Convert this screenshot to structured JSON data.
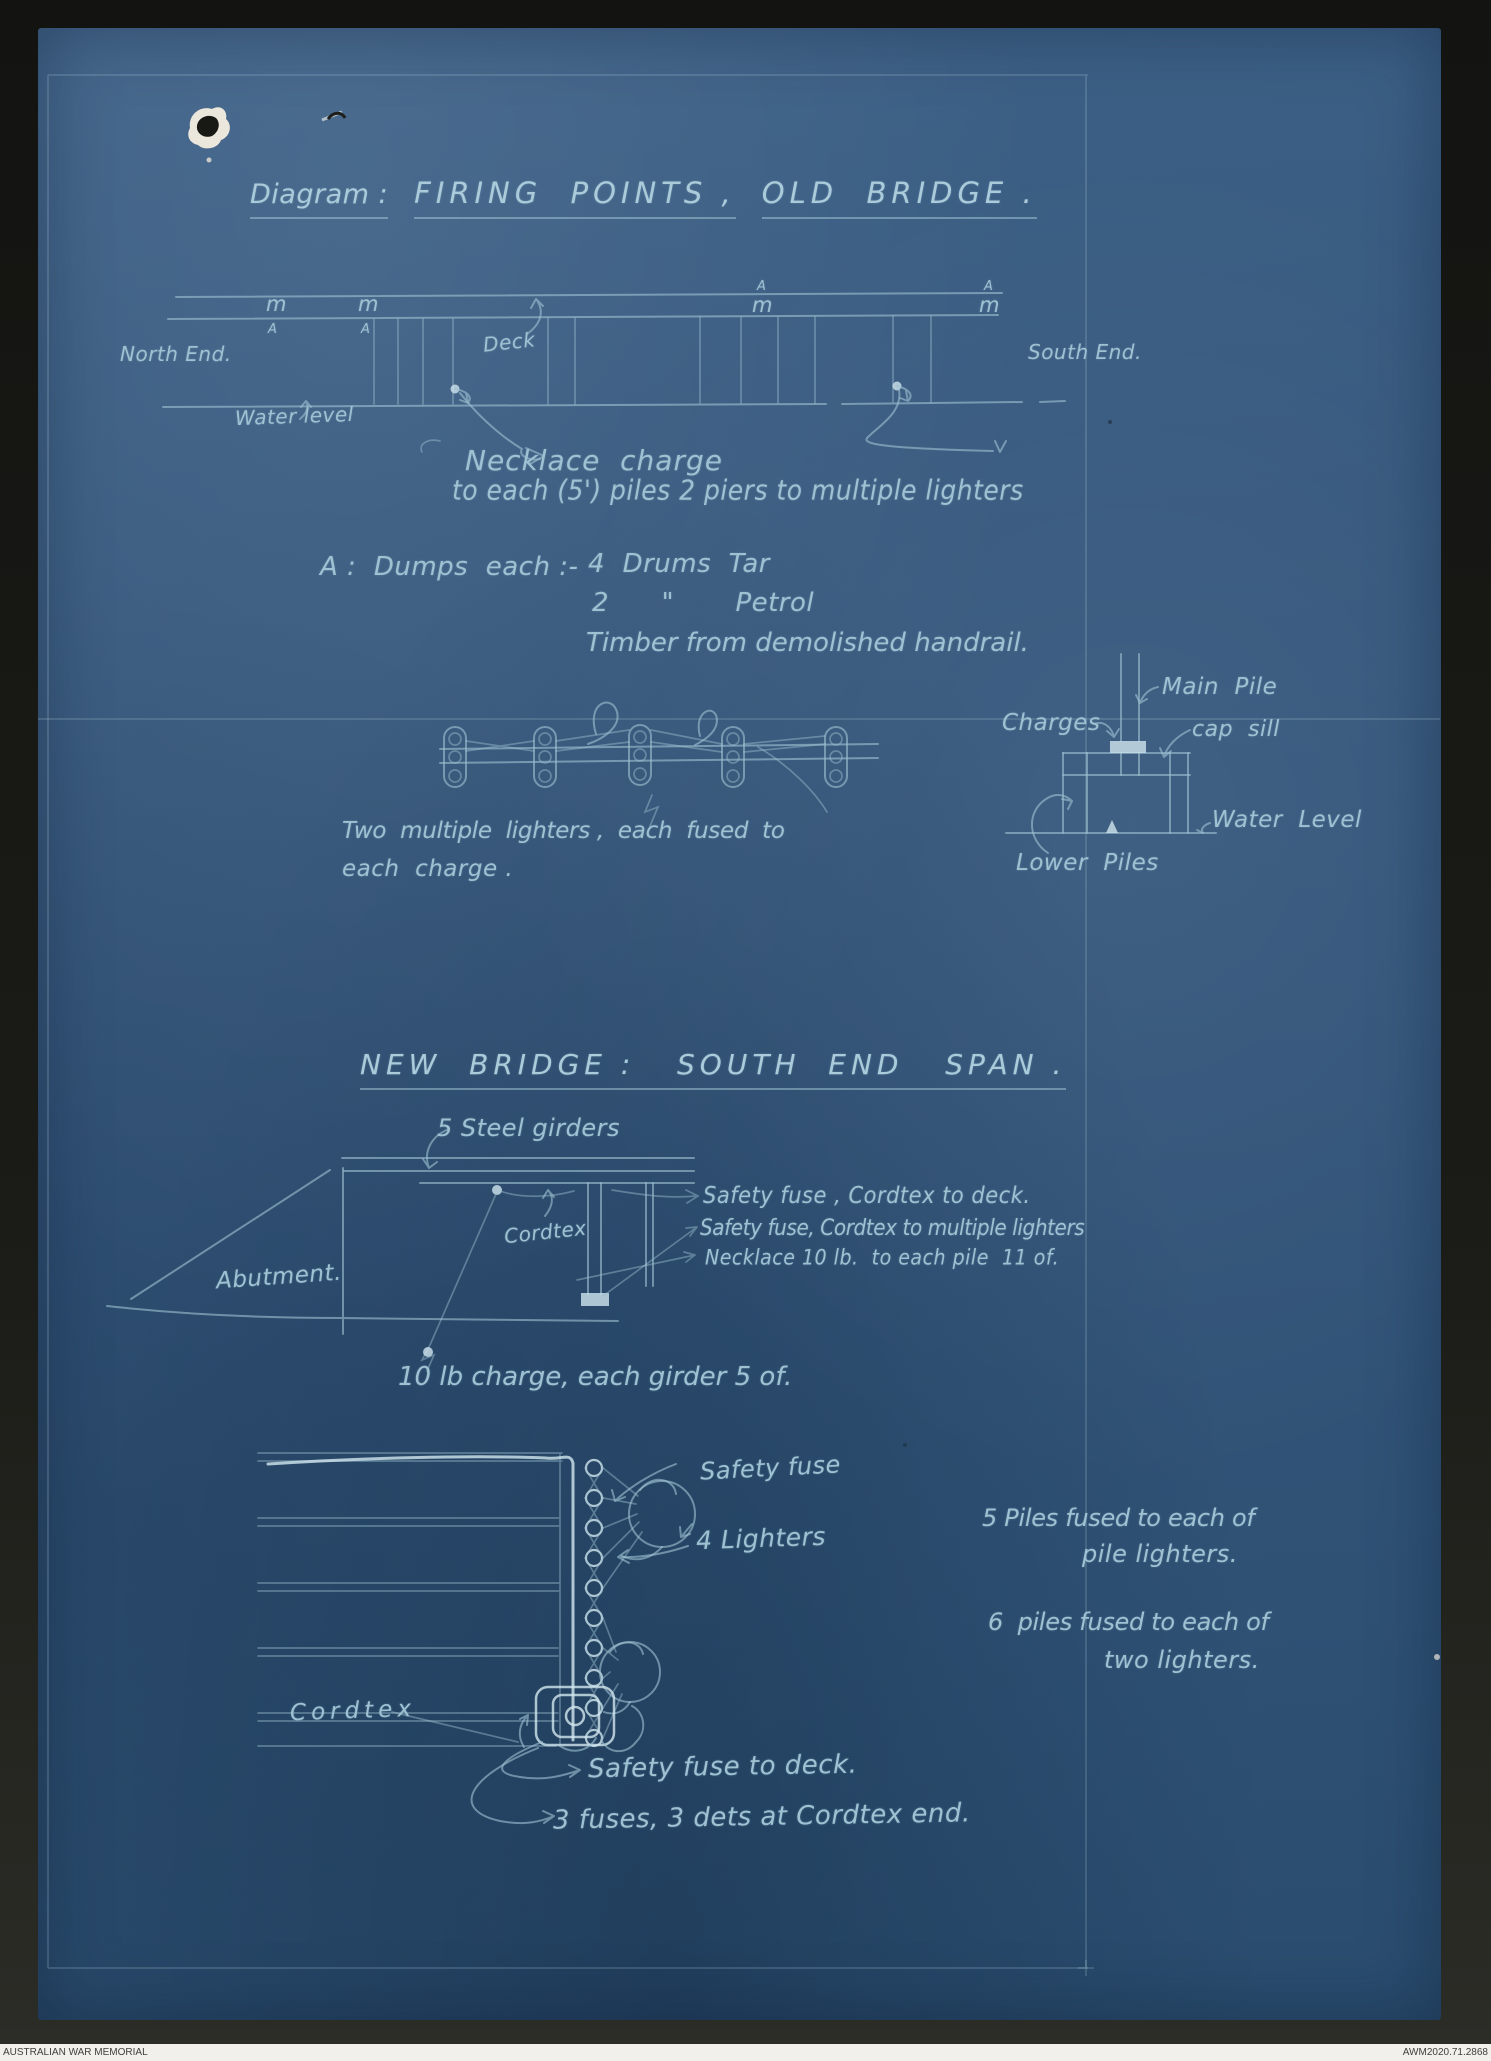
{
  "document": {
    "footer": {
      "org": "AUSTRALIAN WAR MEMORIAL",
      "id": "AWM2020.71.2868"
    },
    "colors": {
      "paper_blue": "#33557a",
      "ink_pale": "#9dc0d0",
      "surround_black": "#1b1b17"
    }
  },
  "old_bridge": {
    "title_label": "Diagram :",
    "title_part1": "FIRING  POINTS ,",
    "title_part2": "OLD  BRIDGE .",
    "north_end": "North End.",
    "south_end": "South End.",
    "deck": "Deck",
    "water_level": "Water level",
    "marker_m": "m",
    "marker_a": "A",
    "necklace_line1": "Necklace  charge",
    "necklace_line2": "to each (5') piles 2 piers to multiple lighters",
    "dumps_heading": "A :  Dumps  each :-",
    "dumps_item1": "4  Drums  Tar",
    "dumps_item2": "2      \"       Petrol",
    "dumps_item3": "Timber from demolished handrail.",
    "lighters_caption_line1": "Two  multiple  lighters ,  each  fused  to",
    "lighters_caption_line2": "each  charge .",
    "pier_detail": {
      "charges": "Charges",
      "main_pile": "Main  Pile",
      "cap_sill": "cap  sill",
      "water_level": "Water  Level",
      "lower_piles": "Lower  Piles"
    }
  },
  "new_bridge": {
    "title": "NEW  BRIDGE :   SOUTH  END   SPAN .",
    "steel_girders": "5 Steel girders",
    "safety_fuse_deck": "Safety fuse , Cordtex to deck.",
    "safety_fuse_lighters": "Safety fuse, Cordtex to multiple lighters",
    "necklace_pile": "Necklace 10 lb.  to each pile  11 of.",
    "abutment": "Abutment.",
    "cordtex_side": "Cordtex",
    "charge_note": "10 lb charge, each girder 5 of.",
    "safety_fuse": "Safety fuse",
    "lighters": "4 Lighters",
    "piles_note1_line1": "5 Piles fused to each of",
    "piles_note1_line2": "pile lighters.",
    "piles_note2_line1": "6  piles fused to each of",
    "piles_note2_line2": "two lighters.",
    "cordtex_plan": "Cordtex",
    "fuse_to_deck": "Safety fuse to deck.",
    "fuses_note": "3 fuses, 3 dets at Cordtex end."
  }
}
